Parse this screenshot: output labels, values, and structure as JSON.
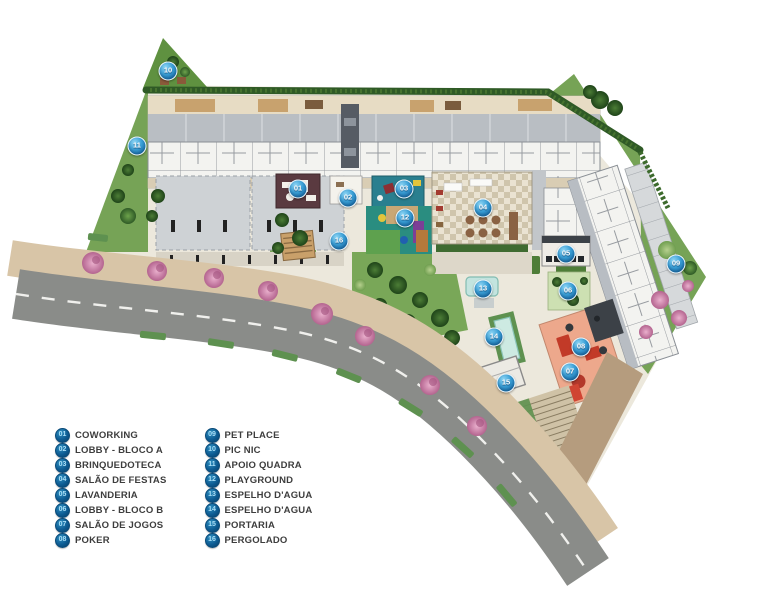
{
  "plan": {
    "title": "implantacao-site-plan",
    "markers": [
      {
        "num": "01",
        "name": "coworking",
        "x": 298,
        "y": 189
      },
      {
        "num": "02",
        "name": "lobby-bloco-a",
        "x": 348,
        "y": 198
      },
      {
        "num": "03",
        "name": "brinquedoteca",
        "x": 404,
        "y": 189
      },
      {
        "num": "04",
        "name": "salao-de-festas",
        "x": 483,
        "y": 208
      },
      {
        "num": "05",
        "name": "lavanderia",
        "x": 566,
        "y": 254
      },
      {
        "num": "06",
        "name": "lobby-bloco-b",
        "x": 568,
        "y": 291
      },
      {
        "num": "07",
        "name": "salao-de-jogos",
        "x": 570,
        "y": 372
      },
      {
        "num": "08",
        "name": "poker",
        "x": 581,
        "y": 347
      },
      {
        "num": "09",
        "name": "pet-place",
        "x": 676,
        "y": 264
      },
      {
        "num": "10",
        "name": "pic-nic",
        "x": 168,
        "y": 71
      },
      {
        "num": "11",
        "name": "apoio-quadra",
        "x": 137,
        "y": 146
      },
      {
        "num": "12",
        "name": "playground",
        "x": 405,
        "y": 218
      },
      {
        "num": "13",
        "name": "espelho-dagua",
        "x": 483,
        "y": 289
      },
      {
        "num": "14",
        "name": "espelho-dagua-2",
        "x": 494,
        "y": 337
      },
      {
        "num": "15",
        "name": "portaria",
        "x": 506,
        "y": 383
      },
      {
        "num": "16",
        "name": "pergolado",
        "x": 339,
        "y": 241
      }
    ],
    "legend": {
      "column1": [
        {
          "num": "01",
          "label": "COWORKING"
        },
        {
          "num": "02",
          "label": "LOBBY - BLOCO A"
        },
        {
          "num": "03",
          "label": "BRINQUEDOTECA"
        },
        {
          "num": "04",
          "label": "SALÃO DE FESTAS"
        },
        {
          "num": "05",
          "label": "LAVANDERIA"
        },
        {
          "num": "06",
          "label": "LOBBY - BLOCO B"
        },
        {
          "num": "07",
          "label": "SALÃO DE JOGOS"
        },
        {
          "num": "08",
          "label": "POKER"
        }
      ],
      "column2": [
        {
          "num": "09",
          "label": "PET PLACE"
        },
        {
          "num": "10",
          "label": "PIC NIC"
        },
        {
          "num": "11",
          "label": "APOIO QUADRA"
        },
        {
          "num": "12",
          "label": "PLAYGROUND"
        },
        {
          "num": "13",
          "label": "ESPELHO D'AGUA"
        },
        {
          "num": "14",
          "label": "ESPELHO D'AGUA"
        },
        {
          "num": "15",
          "label": "PORTARIA"
        },
        {
          "num": "16",
          "label": "PERGOLADO"
        }
      ]
    },
    "colors": {
      "marker_blue": "#2b93cf",
      "legend_badge_blue": "#0d5c93",
      "road_gray": "#8a8c89",
      "sidewalk_tan": "#d8c5a7",
      "grass_green": "#79a758",
      "hedge_dark_green": "#2f5a26",
      "building_gray": "#b9bec3",
      "flower_tree_pink": "#d98ab4",
      "games_room_salmon": "#eda88c",
      "water_teal": "#c3e4df"
    }
  }
}
